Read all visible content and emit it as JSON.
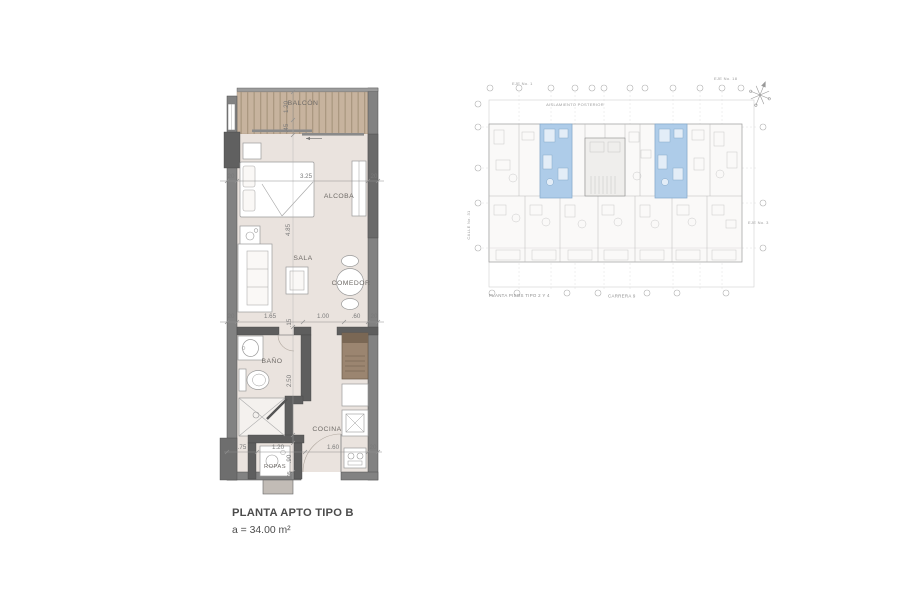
{
  "apartment_plan": {
    "title": "PLANTA APTO TIPO B",
    "area": "a = 34.00 m²",
    "labels": {
      "balcon": "BALCÓN",
      "alcoba": "ALCOBA",
      "sala": "SALA",
      "comedor": "COMEDOR",
      "bano": "BAÑO",
      "cocina": "COCINA",
      "ropas": "ROPAS"
    },
    "dimensions": {
      "balcon_depth": "1.20",
      "balcon_door": ".45",
      "alcoba_width": "3.25",
      "alcoba_length": "4.85",
      "wall_top_left": "20",
      "wall_top_right": "20",
      "mid_wall_left": "20",
      "mid_sala": "1.65",
      "mid_hall": "1.00",
      "mid_cocina": ".60",
      "mid_wall_right": "20",
      "bano_gap": ".15",
      "bano_depth": "2.50",
      "ropas_niche": ".75",
      "ropas_width": "1.20",
      "ropas_depth": ".90",
      "door_gap": ".05",
      "cocina_width": "1.60",
      "wall_bottom_right": "20"
    }
  },
  "building_plan": {
    "caption": "PLANTA PISOS TIPO 2 Y 4",
    "street_label": "CARRERA 9",
    "setback_label": "AISLAMIENTO POSTERIOR",
    "axis_top_left": "EJE No. 1",
    "axis_top_right": "EJE No. 18",
    "axis_right": "EJE No. 3",
    "street_left_label": "CALLE No. 31",
    "highlighted_units": 2,
    "highlight_color": "#aecce9"
  },
  "colors": {
    "wall": "#828282",
    "wall_dark": "#5e5e5e",
    "floor": "#eae3de",
    "balcony_wood": "#c7b39e",
    "balcony_wood_stripe": "#ab9881",
    "highlight": "#aecce9",
    "plan_line": "#b9b9b9",
    "dim_text": "#7a7a7a"
  }
}
